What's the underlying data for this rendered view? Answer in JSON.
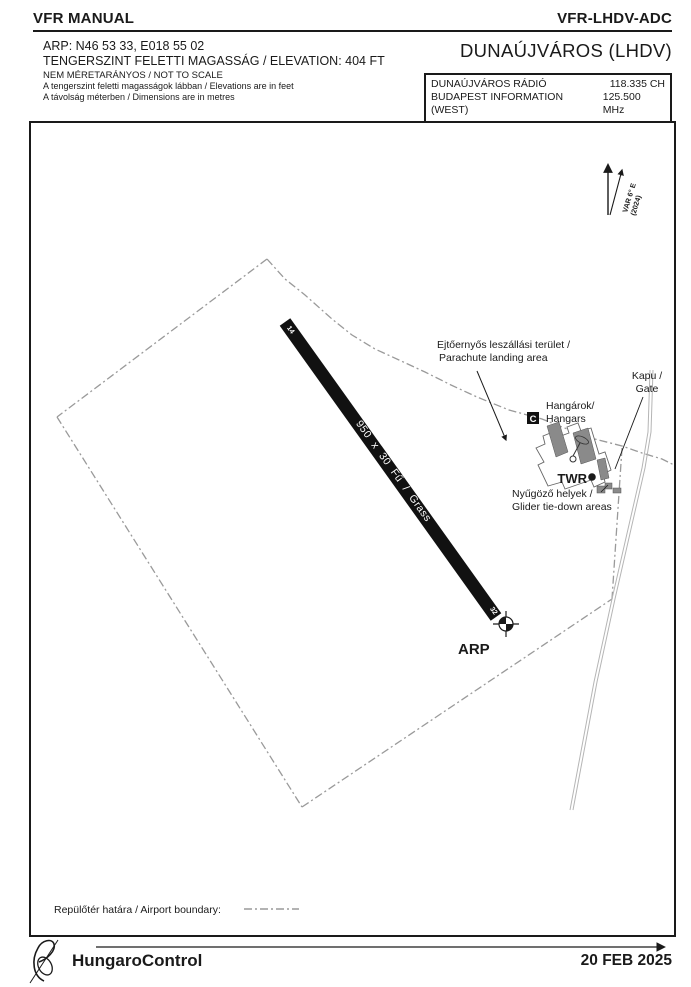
{
  "header": {
    "manual_title": "VFR MANUAL",
    "chart_code": "VFR-LHDV-ADC"
  },
  "info": {
    "arp": "ARP: N46 53 33, E018 55 02",
    "elevation": "TENGERSZINT FELETTI MAGASSÁG / ELEVATION: 404 FT",
    "not_to_scale": "NEM MÉRETARÁNYOS / NOT TO SCALE",
    "note_feet": "A tengerszint feletti magasságok lábban / Elevations are in feet",
    "note_metres": "A távolság méterben / Dimensions are in metres"
  },
  "airport": {
    "title": "DUNAÚJVÁROS (LHDV)"
  },
  "radio": {
    "rows": [
      {
        "station": "DUNAÚJVÁROS RÁDIÓ",
        "freq": "118.335 CH"
      },
      {
        "station": "BUDAPEST INFORMATION (WEST)",
        "freq": "125.500 MHz"
      }
    ]
  },
  "map": {
    "variation": {
      "line1": "VAR 6° E",
      "line2": "(2024)"
    },
    "runway": {
      "label": "950 x 30 Fű / Grass",
      "designator_nw": "14",
      "designator_se": "32"
    },
    "labels": {
      "parachute1": "Ejtőernyős leszállási terület /",
      "parachute2": "Parachute landing area",
      "gate1": "Kapu /",
      "gate2": "Gate",
      "hangars1": "Hangárok/",
      "hangars2": "Hangars",
      "twr": "TWR",
      "glider1": "Nyűgöző helyek /",
      "glider2": "Glider tie-down areas",
      "arp": "ARP",
      "signal_square": "C"
    },
    "legend": {
      "boundary": "Repülőtér határa / Airport boundary:"
    }
  },
  "footer": {
    "organisation": "HungaroControl",
    "date": "20 FEB 2025"
  },
  "colors": {
    "ink": "#1a1a1a",
    "boundary_gray": "#9a9a9a",
    "building_gray": "#8a8a8a",
    "road_gray": "#b5b5b5",
    "runway_black": "#111111"
  }
}
